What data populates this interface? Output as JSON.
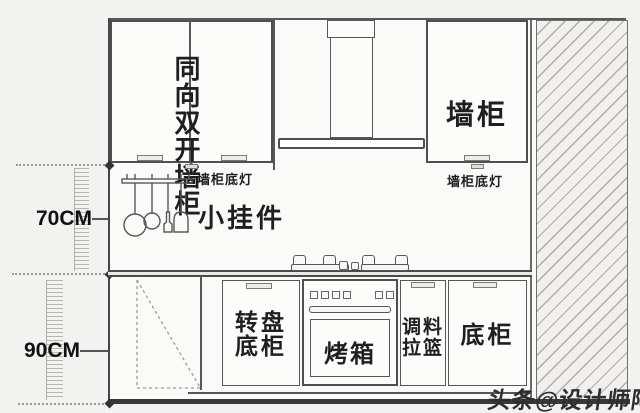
{
  "colors": {
    "background": "#f2f2f0",
    "paper": "#fafaf8",
    "line": "#575757",
    "heavy_border": "#383838",
    "hatch_line": "#aeaca8",
    "text": "#1f1f1f"
  },
  "dimensions": {
    "upper": {
      "label": "70CM"
    },
    "lower": {
      "label": "90CM"
    }
  },
  "wall_cabinets": {
    "double_door": {
      "lines": [
        "同向",
        "双开",
        "墙柜"
      ]
    },
    "right": {
      "label": "墙柜"
    },
    "under_light_left": {
      "label": "墙柜底灯"
    },
    "under_light_right": {
      "label": "墙柜底灯"
    }
  },
  "midwall": {
    "hanging_label": "小挂件"
  },
  "base_cabinets": {
    "carousel": {
      "lines": [
        "转盘",
        "底柜"
      ]
    },
    "oven": {
      "label": "烤箱"
    },
    "spice_basket": {
      "lines": [
        "调料",
        "拉篮"
      ]
    },
    "base": {
      "label": "底柜"
    }
  },
  "watermark": "头条@设计师阿爽",
  "icons": {
    "range_hood": "range-hood-icon",
    "gas_stove": "gas-stove-icon",
    "utensil_rack": "utensil-rack-icon",
    "wall_hatch": "wall-hatch-pattern",
    "door_handle": "door-handle",
    "under_cabinet_light": "under-cabinet-light-icon",
    "dimension_marker": "dimension-diamond-marker"
  }
}
